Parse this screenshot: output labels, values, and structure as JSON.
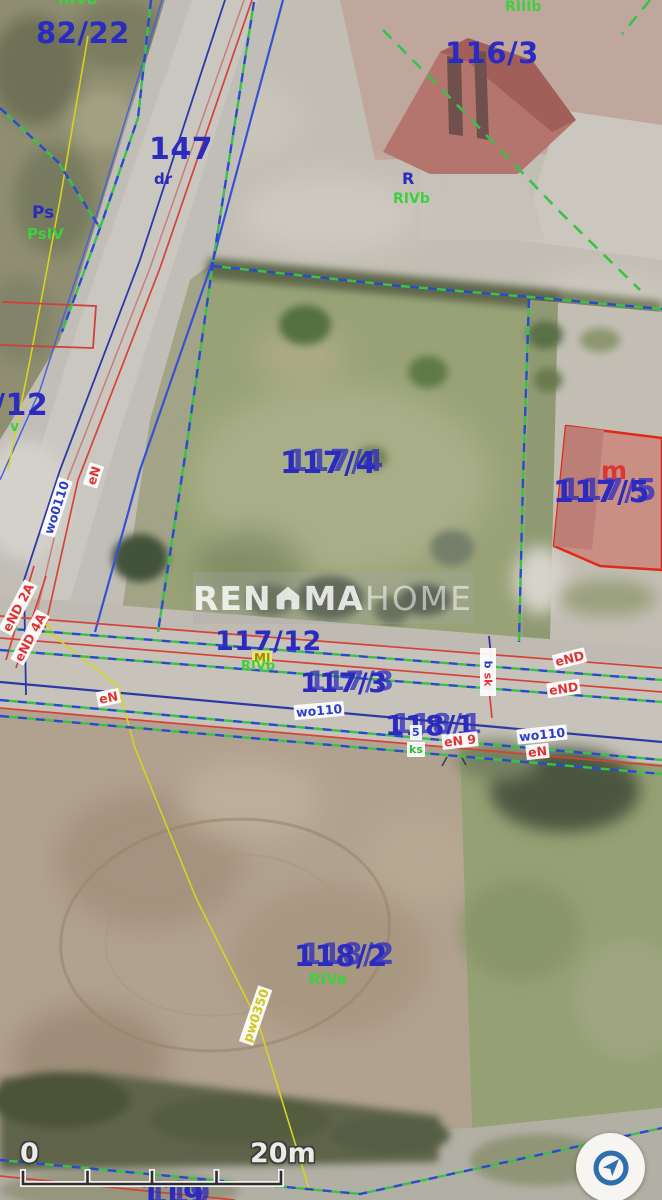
{
  "map": {
    "parcel_labels": {
      "p82_22": "82/22",
      "p116_3": "116/3",
      "p147": "147",
      "p12": "/12",
      "p117_4": "117/4",
      "p117_5": "117/5",
      "p117_12": "117/12",
      "p117_3": "117/3",
      "p118_1": "118/1",
      "p118_2": "118/2",
      "p119": "119"
    },
    "land_use_labels": {
      "rivb_top": "RIVb",
      "riiib": "RIIIb",
      "dr": "dr",
      "ps": "Ps",
      "psiv": "PsIV",
      "r": "R",
      "rivb_center": "RIVb",
      "rivb_road": "RIVb",
      "riva": "RIVa",
      "v_partial": "v"
    },
    "utility_labels": {
      "wo0110": "wo0110",
      "en_road1": "eN",
      "end_2a": "eND 2A",
      "end_4a": "eND 4A",
      "mj": "MJ",
      "b": "b",
      "sk": "sk",
      "end_right_1": "eND",
      "end_right_2": "eND",
      "wo110_mid": "wo110",
      "u5": "5",
      "ks": "ks",
      "en9": "eN 9",
      "wo110_right": "wo110",
      "en_right": "eN",
      "en_left": "eN",
      "pw0350": "pw0350",
      "building_m": "m"
    }
  },
  "watermark": {
    "part_bold_1": "REN",
    "part_bold_2": "MA",
    "part_light": "HOME",
    "icon": "house-icon"
  },
  "scale_bar": {
    "start": "0",
    "end": "20m"
  },
  "controls": {
    "locate_button_icon": "navigation-arrow-icon"
  },
  "colors": {
    "parcel_number_blue": "#2b2bc0",
    "land_class_green": "#3fcf3f",
    "utility_red": "#e03434",
    "utility_blue": "#2a3ec8",
    "utility_yellow": "#cfc71a",
    "boundary_blue": "#2b49cf",
    "boundary_green": "#38c24a",
    "building_outline_red": "#e02818"
  }
}
